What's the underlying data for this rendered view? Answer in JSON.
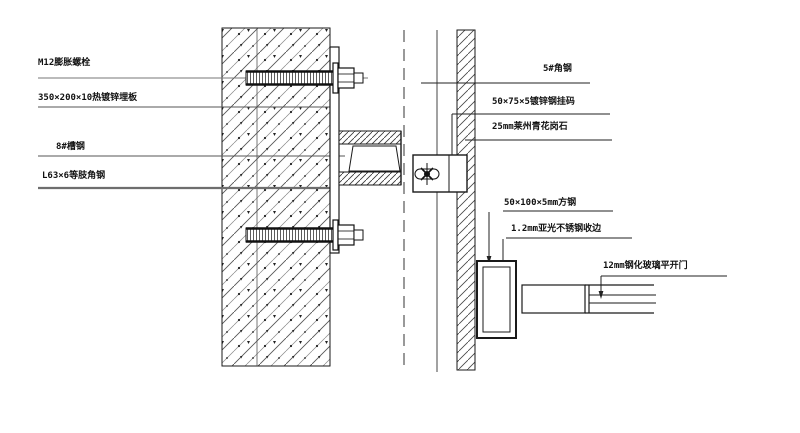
{
  "drawing": {
    "type": "cad-detail-section",
    "labels": {
      "m12_bolt": "M12膨胀螺栓",
      "embed_plate": "350×200×10热镀锌埋板",
      "channel_steel": "8#槽钢",
      "angle_steel": "L63×6等肢角钢",
      "angle_5": "5#角钢",
      "hanger_code": "50×75×5镀锌钢挂码",
      "granite": "25mm莱州青花岗石",
      "square_tube": "50×100×5mm方钢",
      "stainless_trim": "1.2mm亚光不锈钢收边",
      "glass_door": "12mm钢化玻璃平开门"
    },
    "colors": {
      "line": "#1a1a1a",
      "gray_line": "#6e6e6e",
      "hatch": "#444444",
      "background": "#ffffff"
    }
  }
}
